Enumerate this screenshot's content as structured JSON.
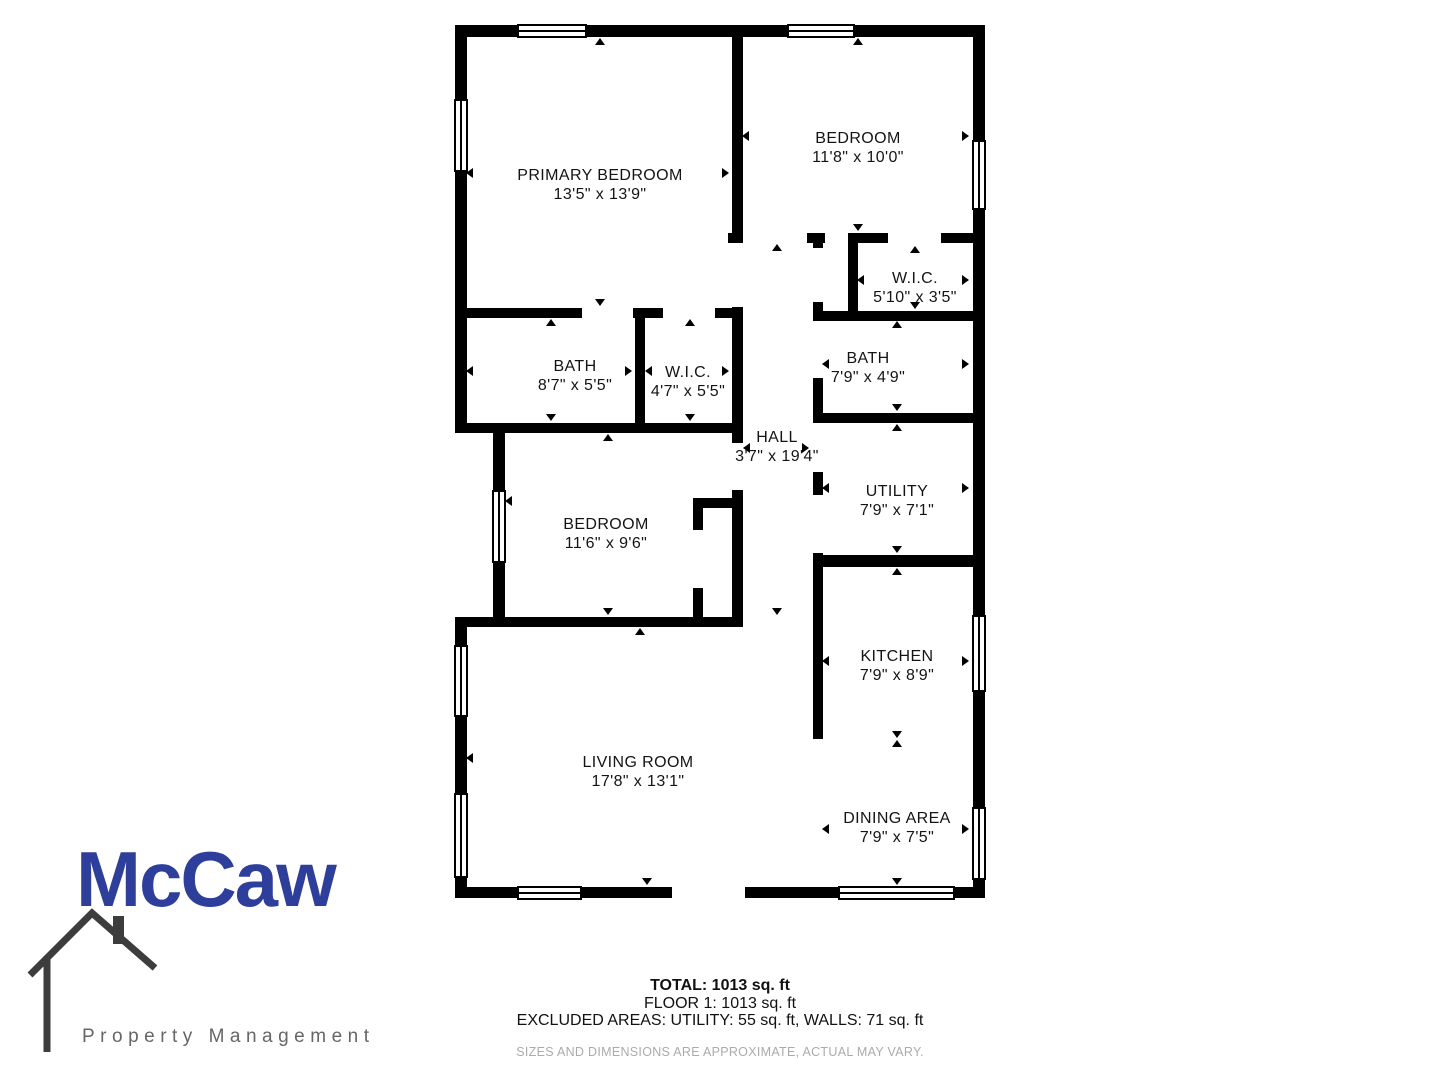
{
  "floorplan": {
    "wall_color": "#000000",
    "rooms": [
      {
        "id": "primary-bedroom",
        "name": "PRIMARY BEDROOM",
        "dims": "13'5\" x 13'9\"",
        "x": 600,
        "y": 185
      },
      {
        "id": "bedroom-2",
        "name": "BEDROOM",
        "dims": "11'8\" x 10'0\"",
        "x": 858,
        "y": 148
      },
      {
        "id": "wic-2",
        "name": "W.I.C.",
        "dims": "5'10\" x 3'5\"",
        "x": 915,
        "y": 288
      },
      {
        "id": "bath-1",
        "name": "BATH",
        "dims": "8'7\" x 5'5\"",
        "x": 575,
        "y": 376
      },
      {
        "id": "wic-1",
        "name": "W.I.C.",
        "dims": "4'7\" x 5'5\"",
        "x": 688,
        "y": 382
      },
      {
        "id": "hall",
        "name": "HALL",
        "dims": "3'7\" x 19'4\"",
        "x": 777,
        "y": 447
      },
      {
        "id": "bath-2",
        "name": "BATH",
        "dims": "7'9\" x 4'9\"",
        "x": 868,
        "y": 368
      },
      {
        "id": "utility",
        "name": "UTILITY",
        "dims": "7'9\" x 7'1\"",
        "x": 897,
        "y": 501
      },
      {
        "id": "bedroom-3",
        "name": "BEDROOM",
        "dims": "11'6\" x 9'6\"",
        "x": 606,
        "y": 534
      },
      {
        "id": "kitchen",
        "name": "KITCHEN",
        "dims": "7'9\" x 8'9\"",
        "x": 897,
        "y": 666
      },
      {
        "id": "living-room",
        "name": "LIVING ROOM",
        "dims": "17'8\" x 13'1\"",
        "x": 638,
        "y": 772
      },
      {
        "id": "dining-area",
        "name": "DINING AREA",
        "dims": "7'9\" x 7'5\"",
        "x": 897,
        "y": 828
      }
    ],
    "walls": [
      [
        455,
        25,
        530,
        12
      ],
      [
        973,
        25,
        12,
        873
      ],
      [
        455,
        887,
        530,
        11
      ],
      [
        455,
        25,
        12,
        408
      ],
      [
        455,
        617,
        12,
        281
      ],
      [
        493,
        423,
        12,
        204
      ],
      [
        455,
        308,
        288,
        10
      ],
      [
        635,
        318,
        10,
        105
      ],
      [
        455,
        423,
        288,
        10
      ],
      [
        455,
        617,
        288,
        10
      ],
      [
        732,
        25,
        11,
        218
      ],
      [
        732,
        307,
        11,
        320
      ],
      [
        693,
        498,
        50,
        10
      ],
      [
        693,
        498,
        10,
        129
      ],
      [
        728,
        233,
        245,
        10
      ],
      [
        848,
        237,
        10,
        74
      ],
      [
        813,
        311,
        160,
        10
      ],
      [
        813,
        233,
        10,
        334
      ],
      [
        813,
        413,
        160,
        10
      ],
      [
        813,
        555,
        160,
        12
      ],
      [
        813,
        567,
        10,
        172
      ]
    ],
    "openings": [
      [
        672,
        886,
        73,
        13
      ],
      [
        582,
        307,
        51,
        12
      ],
      [
        663,
        307,
        52,
        12
      ],
      [
        731,
        443,
        13,
        47
      ],
      [
        692,
        530,
        12,
        58
      ],
      [
        743,
        232,
        64,
        12
      ],
      [
        825,
        232,
        23,
        12
      ],
      [
        888,
        232,
        53,
        12
      ],
      [
        812,
        248,
        12,
        54
      ],
      [
        812,
        321,
        12,
        57
      ],
      [
        812,
        423,
        12,
        49
      ],
      [
        812,
        495,
        12,
        58
      ]
    ],
    "windows": [
      {
        "x": 517,
        "y": 24,
        "w": 70,
        "h": 14,
        "o": "h"
      },
      {
        "x": 787,
        "y": 24,
        "w": 68,
        "h": 14,
        "o": "h"
      },
      {
        "x": 517,
        "y": 886,
        "w": 65,
        "h": 14,
        "o": "h"
      },
      {
        "x": 838,
        "y": 886,
        "w": 117,
        "h": 14,
        "o": "h"
      },
      {
        "x": 454,
        "y": 99,
        "w": 14,
        "h": 73,
        "o": "v"
      },
      {
        "x": 492,
        "y": 490,
        "w": 14,
        "h": 73,
        "o": "v"
      },
      {
        "x": 454,
        "y": 645,
        "w": 14,
        "h": 72,
        "o": "v"
      },
      {
        "x": 454,
        "y": 793,
        "w": 14,
        "h": 85,
        "o": "v"
      },
      {
        "x": 972,
        "y": 140,
        "w": 14,
        "h": 70,
        "o": "v"
      },
      {
        "x": 972,
        "y": 615,
        "w": 14,
        "h": 77,
        "o": "v"
      },
      {
        "x": 972,
        "y": 807,
        "w": 14,
        "h": 73,
        "o": "v"
      }
    ],
    "arrows": [
      [
        600,
        42,
        "up"
      ],
      [
        600,
        303,
        "down"
      ],
      [
        471,
        172,
        "left"
      ],
      [
        727,
        172,
        "right"
      ],
      [
        858,
        42,
        "up"
      ],
      [
        858,
        228,
        "down"
      ],
      [
        747,
        135,
        "left"
      ],
      [
        967,
        135,
        "right"
      ],
      [
        862,
        279,
        "left"
      ],
      [
        967,
        279,
        "right"
      ],
      [
        915,
        250,
        "up"
      ],
      [
        915,
        306,
        "down"
      ],
      [
        471,
        370,
        "left"
      ],
      [
        630,
        370,
        "right"
      ],
      [
        551,
        323,
        "up"
      ],
      [
        551,
        418,
        "down"
      ],
      [
        650,
        370,
        "left"
      ],
      [
        727,
        370,
        "right"
      ],
      [
        690,
        323,
        "up"
      ],
      [
        690,
        418,
        "down"
      ],
      [
        777,
        248,
        "up"
      ],
      [
        748,
        447,
        "left"
      ],
      [
        807,
        447,
        "right"
      ],
      [
        777,
        612,
        "down"
      ],
      [
        827,
        363,
        "left"
      ],
      [
        967,
        363,
        "right"
      ],
      [
        897,
        325,
        "up"
      ],
      [
        897,
        408,
        "down"
      ],
      [
        827,
        487,
        "left"
      ],
      [
        967,
        487,
        "right"
      ],
      [
        897,
        428,
        "up"
      ],
      [
        897,
        550,
        "down"
      ],
      [
        510,
        500,
        "left"
      ],
      [
        608,
        438,
        "up"
      ],
      [
        608,
        612,
        "down"
      ],
      [
        827,
        660,
        "left"
      ],
      [
        967,
        660,
        "right"
      ],
      [
        897,
        572,
        "up"
      ],
      [
        897,
        735,
        "down"
      ],
      [
        471,
        757,
        "left"
      ],
      [
        640,
        632,
        "up"
      ],
      [
        647,
        882,
        "down"
      ],
      [
        827,
        828,
        "left"
      ],
      [
        967,
        828,
        "right"
      ],
      [
        897,
        744,
        "up"
      ],
      [
        897,
        882,
        "down"
      ]
    ]
  },
  "footer": {
    "total": "TOTAL: 1013 sq. ft",
    "floor": "FLOOR 1: 1013 sq. ft",
    "excluded": "EXCLUDED AREAS: UTILITY: 55 sq. ft, WALLS: 71 sq. ft",
    "disclaimer": "SIZES AND DIMENSIONS ARE APPROXIMATE, ACTUAL MAY VARY."
  },
  "logo": {
    "name": "McCaw",
    "tagline": "Property Management",
    "name_color": "#2e3f9b",
    "tagline_color": "#666666",
    "house_color": "#3d3d3d"
  }
}
